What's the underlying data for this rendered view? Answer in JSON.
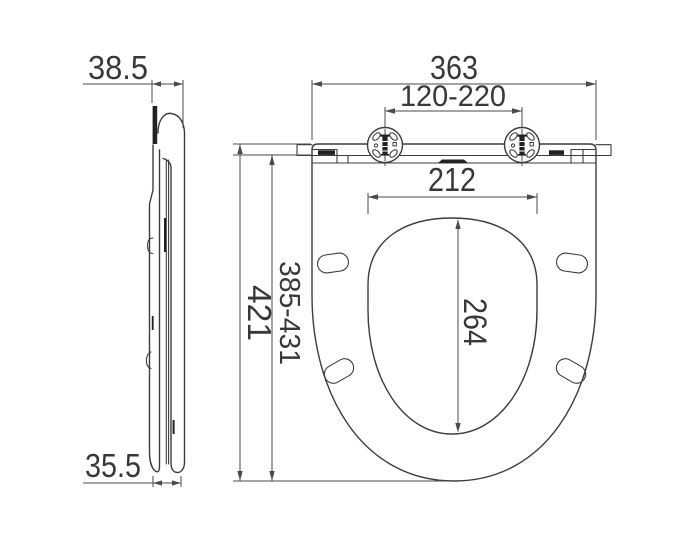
{
  "drawing": {
    "type": "technical-dimension-drawing",
    "subject": "toilet seat — side profile view and top plan view",
    "units": "mm"
  },
  "dimensions": {
    "side_top_thickness": "38.5",
    "side_bottom_thickness": "35.5",
    "overall_width": "363",
    "hinge_hole_spacing": "120-220",
    "bowl_opening_width": "212",
    "bowl_opening_depth": "264",
    "adjustable_depth": "385-431",
    "overall_depth": "421"
  },
  "colors": {
    "line": "#3c3c3c",
    "dim_line": "#4a4a4a",
    "text": "#383838",
    "background": "#ffffff"
  }
}
